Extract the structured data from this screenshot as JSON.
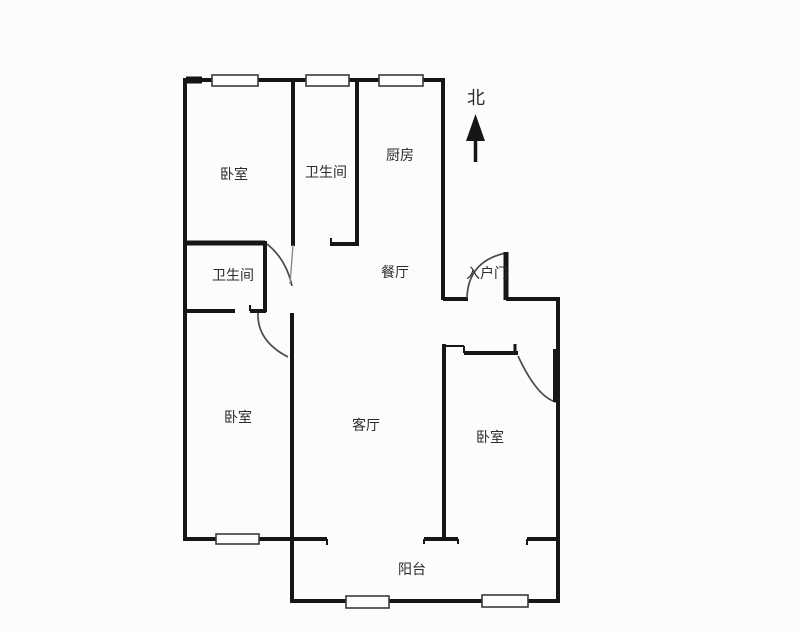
{
  "meta": {
    "canvas": {
      "width": 800,
      "height": 632
    },
    "background_color": "#fcfcfc",
    "wall_color": "#161616",
    "text_color": "#2b2b2b",
    "door_arc_color": "#4a4a4a",
    "window_stroke_color": "#3a3a3a",
    "window_fill_color": "#fdfdfd"
  },
  "north_indicator": {
    "label": "北",
    "label_x": 476,
    "label_y": 104,
    "font_size": 18,
    "arrow_head": "475.5,114 466,141 485,141",
    "arrow_shaft": [
      475.5,
      140,
      475.5,
      162,
      3.5
    ]
  },
  "rooms": [
    {
      "id": "bedroom-top-left",
      "label": "卧室",
      "x": 234,
      "y": 179,
      "font_size": 14
    },
    {
      "id": "bathroom-top",
      "label": "卫生间",
      "x": 326,
      "y": 177,
      "font_size": 14
    },
    {
      "id": "kitchen",
      "label": "厨房",
      "x": 400,
      "y": 160,
      "font_size": 14
    },
    {
      "id": "bathroom-middle",
      "label": "卫生间",
      "x": 233,
      "y": 280,
      "font_size": 14
    },
    {
      "id": "dining-room",
      "label": "餐厅",
      "x": 395,
      "y": 277,
      "font_size": 14
    },
    {
      "id": "entry-door",
      "label": "入户门",
      "x": 487,
      "y": 278,
      "font_size": 14
    },
    {
      "id": "bedroom-bottom-left",
      "label": "卧室",
      "x": 238,
      "y": 422,
      "font_size": 14
    },
    {
      "id": "living-room",
      "label": "客厅",
      "x": 366,
      "y": 430,
      "font_size": 14
    },
    {
      "id": "bedroom-bottom-right",
      "label": "卧室",
      "x": 490,
      "y": 442,
      "font_size": 14
    },
    {
      "id": "balcony",
      "label": "阳台",
      "x": 412,
      "y": 574,
      "font_size": 14
    }
  ],
  "walls": [
    [
      183,
      80,
      443,
      80,
      4
    ],
    [
      186,
      80,
      202,
      80,
      7
    ],
    [
      185,
      78,
      185,
      541,
      4
    ],
    [
      293,
      80,
      293,
      246,
      4
    ],
    [
      357,
      80,
      357,
      246,
      4
    ],
    [
      330,
      244,
      357,
      244,
      4
    ],
    [
      183,
      243,
      265,
      243,
      5
    ],
    [
      265,
      241,
      265,
      312,
      4
    ],
    [
      183,
      311,
      235,
      311,
      4
    ],
    [
      250,
      311,
      266,
      311,
      4
    ],
    [
      292,
      313,
      292,
      541,
      4
    ],
    [
      443,
      78,
      443,
      300,
      4
    ],
    [
      443,
      299,
      468,
      299,
      4
    ],
    [
      506,
      299,
      560,
      299,
      4
    ],
    [
      558,
      299,
      558,
      603,
      4
    ],
    [
      444,
      344,
      444,
      541,
      4
    ],
    [
      464,
      353,
      518,
      353,
      4
    ],
    [
      183,
      539,
      327,
      539,
      4
    ],
    [
      424,
      539,
      458,
      539,
      4
    ],
    [
      527,
      539,
      558,
      539,
      4
    ],
    [
      292,
      539,
      292,
      603,
      4
    ],
    [
      292,
      601,
      558,
      601,
      4
    ]
  ],
  "wall_ticks": [
    [
      331,
      238,
      331,
      244,
      2
    ],
    [
      250,
      305,
      250,
      311,
      2
    ],
    [
      444,
      346,
      464,
      346,
      2
    ],
    [
      464,
      346,
      464,
      353,
      2
    ],
    [
      515,
      344,
      515,
      354,
      3
    ],
    [
      327,
      539,
      327,
      545,
      2
    ],
    [
      424,
      539,
      424,
      544,
      2
    ],
    [
      458,
      539,
      458,
      544,
      2
    ],
    [
      527,
      539,
      527,
      545,
      2
    ]
  ],
  "windows": [
    [
      212,
      75,
      46,
      11
    ],
    [
      306,
      75,
      43,
      11
    ],
    [
      379,
      75,
      44,
      11
    ],
    [
      216,
      534,
      43,
      10
    ],
    [
      346,
      596,
      43,
      12
    ],
    [
      482,
      595,
      46,
      12
    ]
  ],
  "door_arcs": [
    "M267,244 Q286,259 292,286",
    "M258,313 Q257,341 288,357",
    "M506,253 Q468,261 467,298",
    "M518,356 Q537,397 556,402"
  ],
  "door_leaves": [
    [
      506,
      252,
      506,
      300,
      5,
      "#161616"
    ],
    [
      556,
      349,
      556,
      402,
      6,
      "#161616"
    ],
    [
      293,
      245,
      290,
      284,
      1.4,
      "#8a8a8a"
    ]
  ]
}
